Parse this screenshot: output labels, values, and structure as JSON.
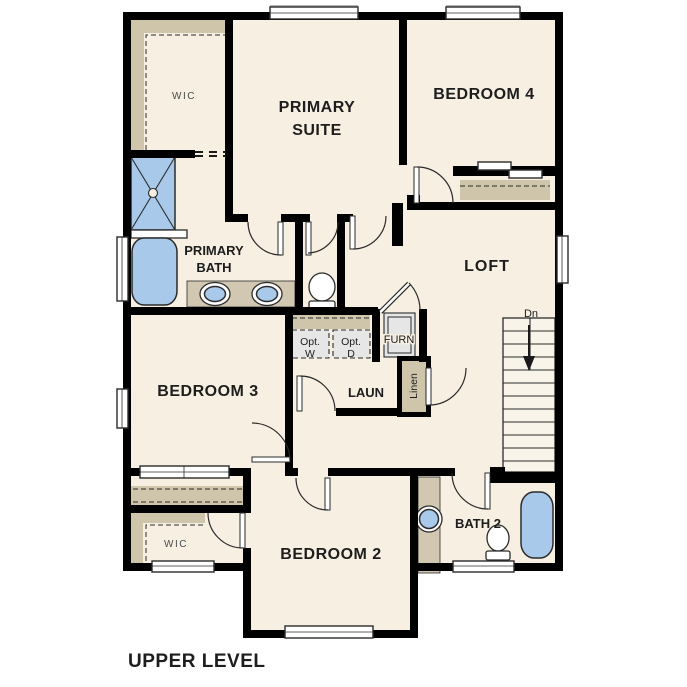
{
  "caption": "UPPER LEVEL",
  "colors": {
    "wall": "#000000",
    "floor": "#f6efe2",
    "shelf_tan": "#cfc5ab",
    "counter_tan": "#d2c8b2",
    "fixture_blue": "#a8c9e9",
    "appliance_gray": "#e6e6e6",
    "background": "#ffffff"
  },
  "rooms": {
    "primary_wic": {
      "label": "WIC"
    },
    "primary_suite": {
      "line1": "PRIMARY",
      "line2": "SUITE"
    },
    "bedroom4": {
      "label": "BEDROOM 4"
    },
    "primary_bath": {
      "line1": "PRIMARY",
      "line2": "BATH"
    },
    "loft": {
      "label": "LOFT"
    },
    "bedroom3": {
      "label": "BEDROOM 3"
    },
    "laundry": {
      "label": "LAUN"
    },
    "opt_washer": {
      "line1": "Opt.",
      "line2": "W"
    },
    "opt_dryer": {
      "line1": "Opt.",
      "line2": "D"
    },
    "furnace": {
      "label": "FURN"
    },
    "linen": {
      "label": "Linen"
    },
    "stairs": {
      "label": "Dn"
    },
    "bedroom2": {
      "label": "BEDROOM 2"
    },
    "bath2": {
      "label": "BATH 2"
    },
    "bedroom2_wic": {
      "label": "WIC"
    }
  }
}
